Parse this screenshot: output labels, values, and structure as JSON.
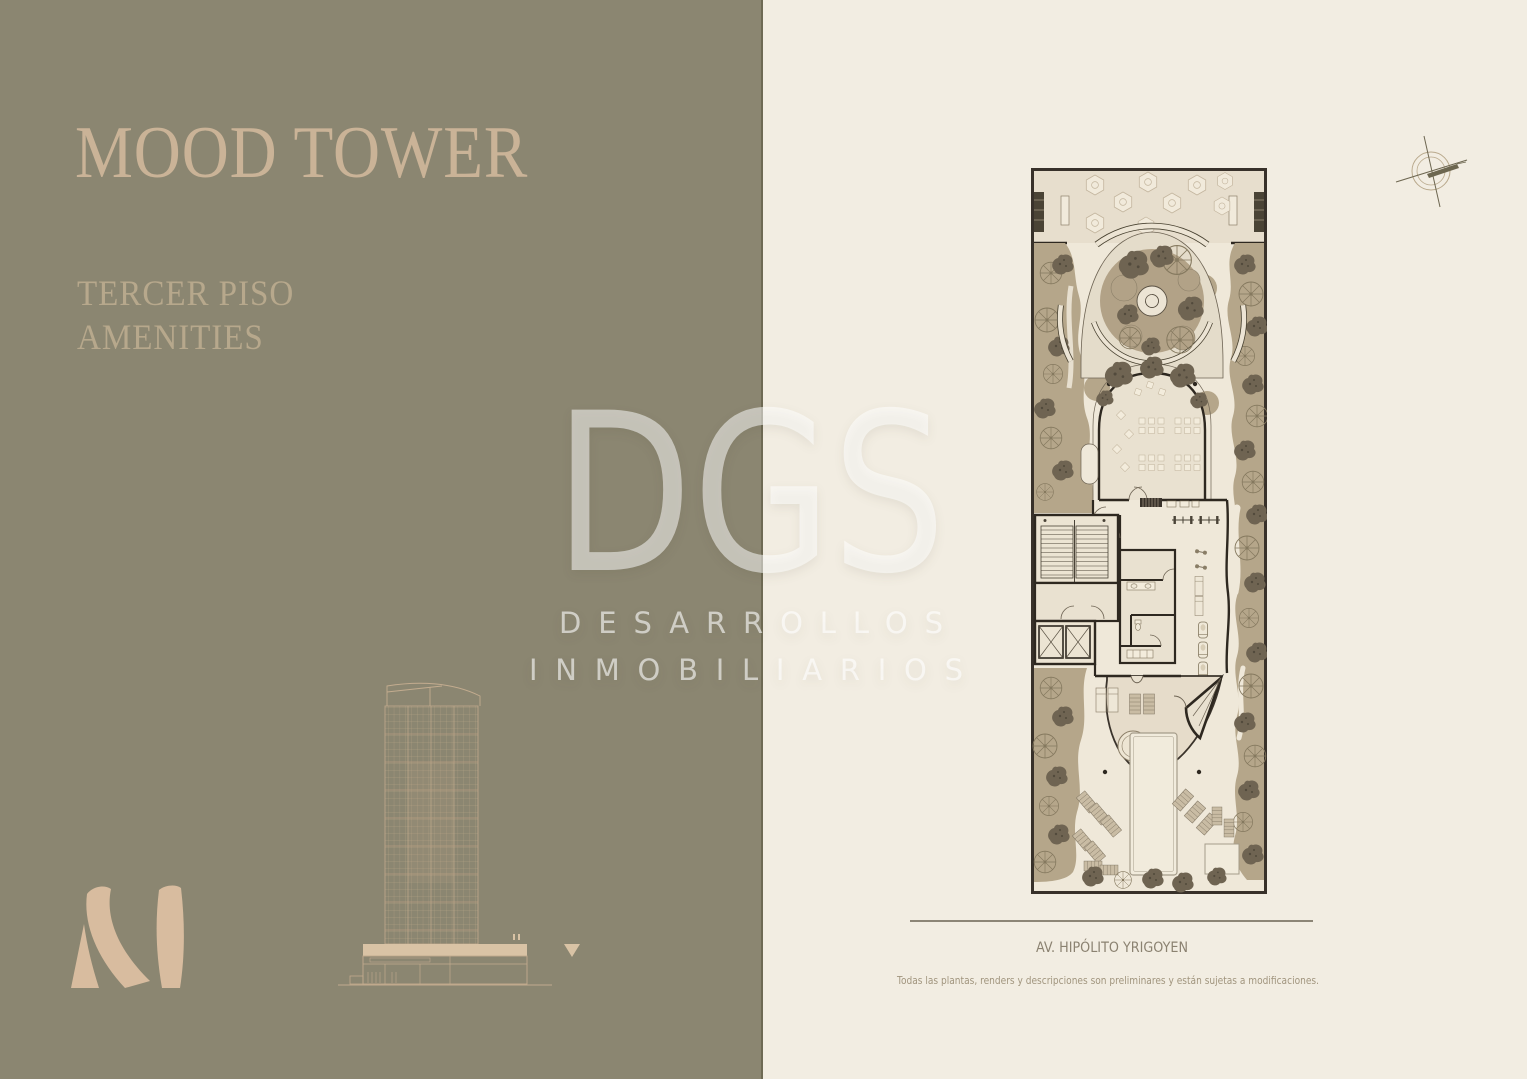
{
  "page": {
    "title": "MOOD TOWER",
    "subtitle_lines": [
      "TERCER PISO",
      "AMENITIES"
    ]
  },
  "watermark": {
    "acronym": "DGS",
    "line1": "DESARROLLOS",
    "line2": "INMOBILIARIOS"
  },
  "plan_caption": {
    "street_label": "AV. HIPÓLITO YRIGOYEN",
    "disclaimer": "Todas las plantas, renders y descripciones son preliminares y están sujetas a modificaciones."
  },
  "colors": {
    "olive_panel": "#8b8671",
    "cream_panel": "#f2ede2",
    "title_beige": "#cab397",
    "logo_beige": "#d8bc9f",
    "plan_wall": "#2e2820",
    "plan_greenery": "#b5a68a",
    "caption_text": "#8b8271"
  }
}
